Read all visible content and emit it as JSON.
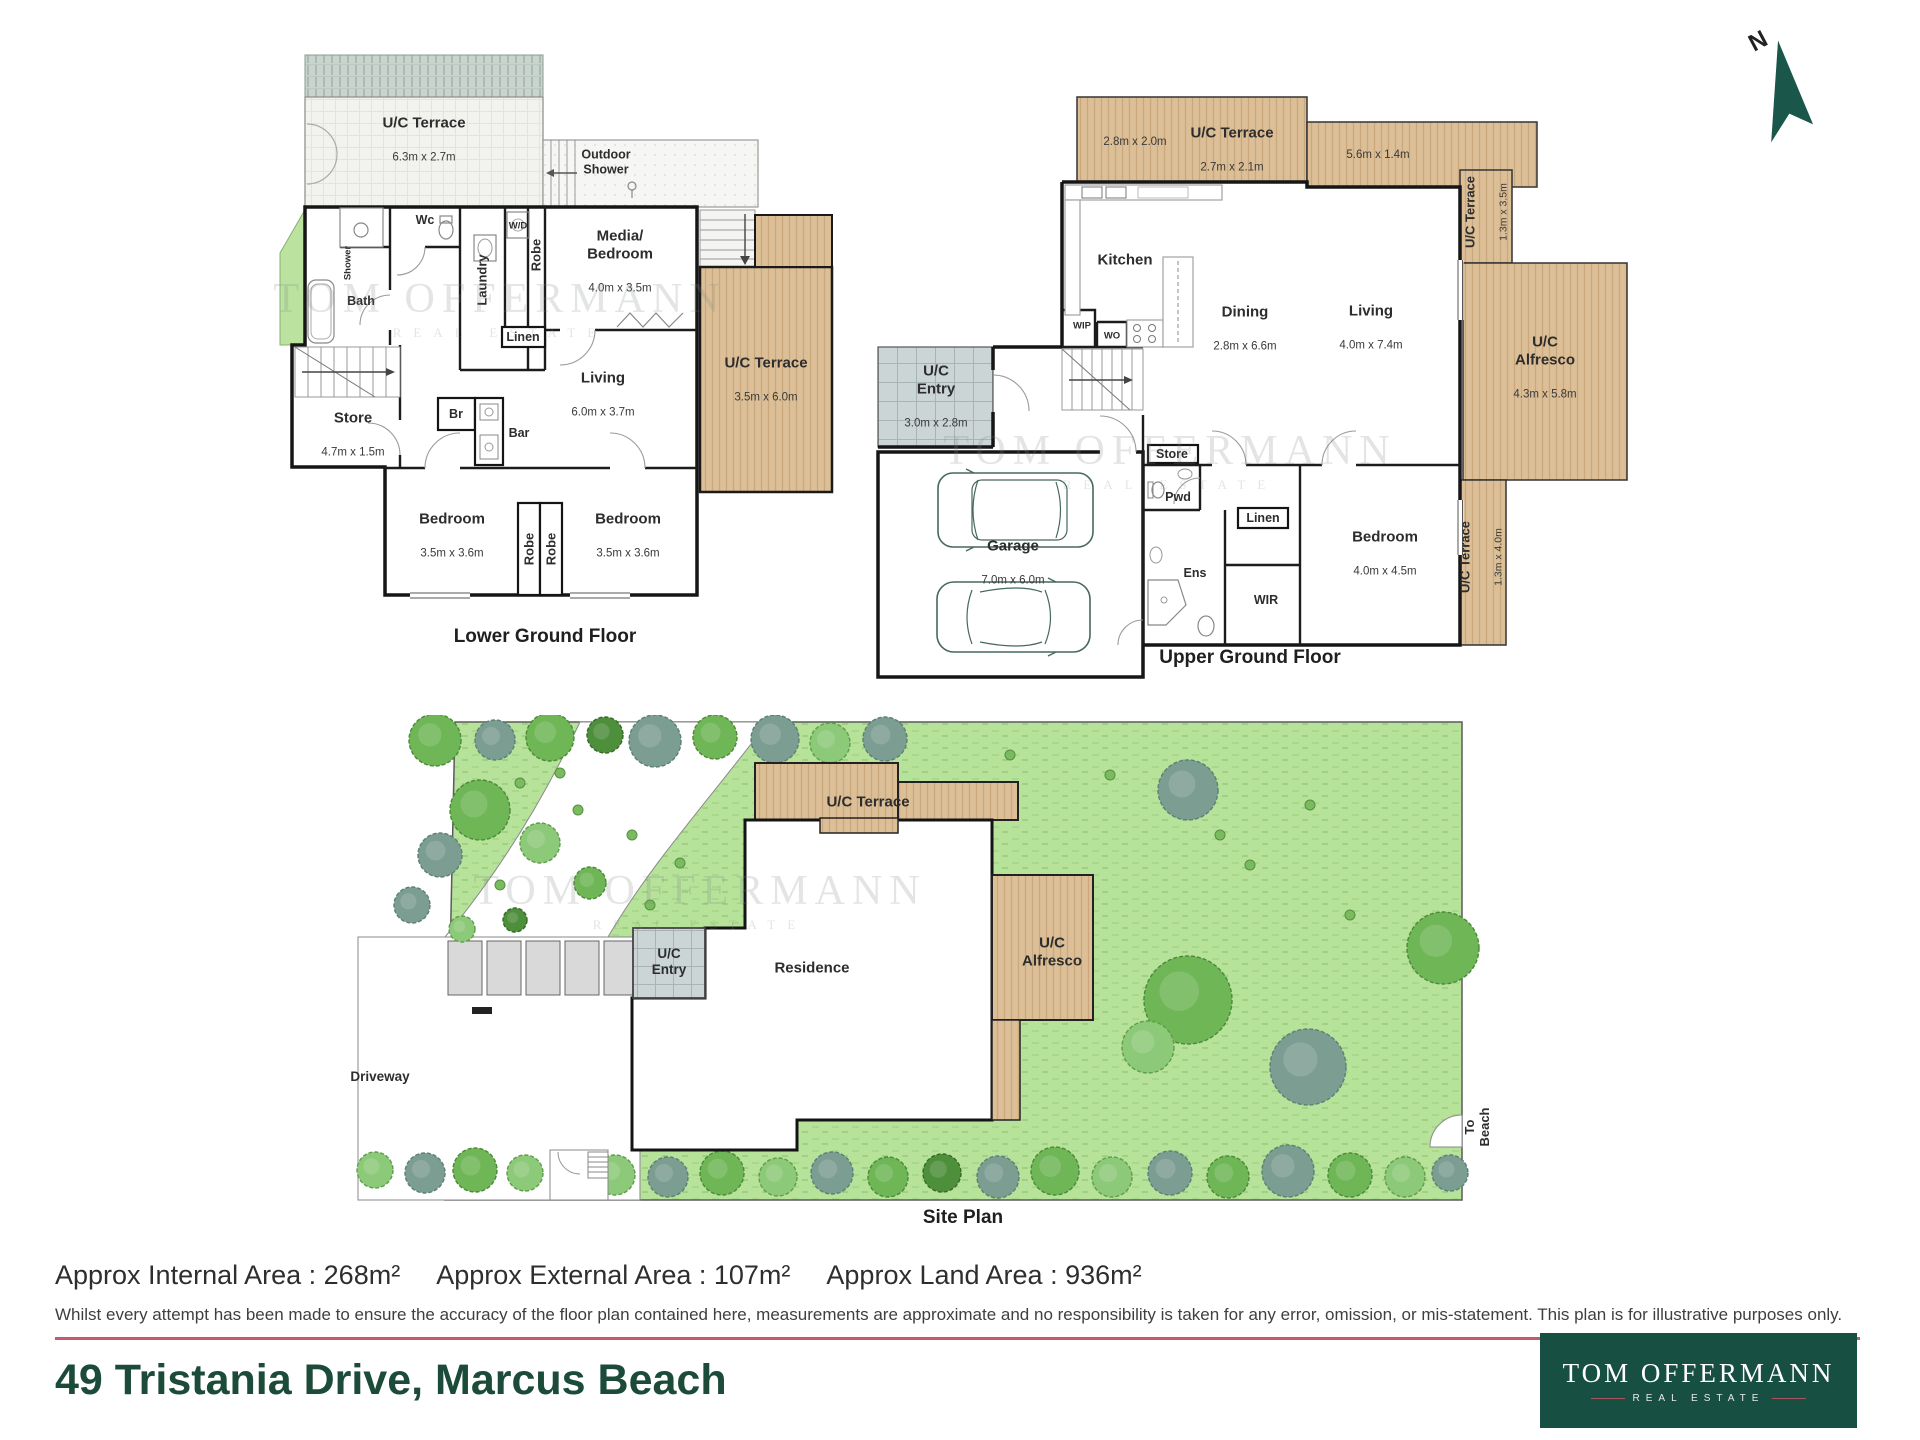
{
  "compass": {
    "label": "N"
  },
  "watermark": {
    "name": "TOM OFFERMANN",
    "tagline": "REAL ESTATE"
  },
  "lower_floor": {
    "title": "Lower Ground Floor",
    "terrace_top": {
      "name": "U/C Terrace",
      "dims": "6.3m x 2.7m"
    },
    "outdoor_shower": {
      "name": "Outdoor\nShower"
    },
    "wc": {
      "name": "Wc"
    },
    "shower": {
      "name": "Shower"
    },
    "bath": {
      "name": "Bath"
    },
    "laundry": {
      "name": "Laundry"
    },
    "wd": {
      "name": "W/D"
    },
    "robe_top": {
      "name": "Robe"
    },
    "media_bedroom": {
      "name": "Media/\nBedroom",
      "dims": "4.0m x 3.5m"
    },
    "linen": {
      "name": "Linen"
    },
    "living": {
      "name": "Living",
      "dims": "6.0m x 3.7m"
    },
    "store": {
      "name": "Store",
      "dims": "4.7m x 1.5m"
    },
    "br": {
      "name": "Br"
    },
    "bar": {
      "name": "Bar"
    },
    "bedroom_left": {
      "name": "Bedroom",
      "dims": "3.5m x 3.6m"
    },
    "robe_left": {
      "name": "Robe"
    },
    "robe_right": {
      "name": "Robe"
    },
    "bedroom_right": {
      "name": "Bedroom",
      "dims": "3.5m x 3.6m"
    },
    "terrace_right": {
      "name": "U/C Terrace",
      "dims": "3.5m x 6.0m"
    }
  },
  "upper_floor": {
    "title": "Upper Ground Floor",
    "terrace_top": {
      "name": "U/C Terrace",
      "dims": "2.7m x 2.1m",
      "left_dims": "2.8m x 2.0m",
      "right_dims": "5.6m x 1.4m"
    },
    "terrace_right": {
      "name": "U/C Terrace",
      "dims": "1.3m x 3.5m"
    },
    "alfresco": {
      "name": "U/C\nAlfresco",
      "dims": "4.3m x 5.8m"
    },
    "terrace_bottom": {
      "name": "U/C Terrace",
      "dims": "1.3m x 4.0m"
    },
    "kitchen": {
      "name": "Kitchen"
    },
    "wip": {
      "name": "WIP"
    },
    "wo": {
      "name": "WO"
    },
    "dining": {
      "name": "Dining",
      "dims": "2.8m x 6.6m"
    },
    "living": {
      "name": "Living",
      "dims": "4.0m x 7.4m"
    },
    "entry": {
      "name": "U/C\nEntry",
      "dims": "3.0m x 2.8m"
    },
    "garage": {
      "name": "Garage",
      "dims": "7.0m x 6.0m"
    },
    "store": {
      "name": "Store"
    },
    "pwd": {
      "name": "Pwd"
    },
    "linen": {
      "name": "Linen"
    },
    "bedroom": {
      "name": "Bedroom",
      "dims": "4.0m x 4.5m"
    },
    "ens": {
      "name": "Ens"
    },
    "wir": {
      "name": "WIR"
    }
  },
  "site_plan": {
    "title": "Site Plan",
    "terrace": {
      "name": "U/C Terrace"
    },
    "alfresco": {
      "name": "U/C\nAlfresco"
    },
    "entry": {
      "name": "U/C\nEntry"
    },
    "residence": {
      "name": "Residence"
    },
    "driveway": {
      "name": "Driveway"
    },
    "to_beach": {
      "name": "To Beach"
    }
  },
  "footer": {
    "internal_area": "Approx Internal Area : 268m²",
    "external_area": "Approx External Area : 107m²",
    "land_area": "Approx Land Area : 936m²",
    "disclaimer": "Whilst every attempt has been made to ensure the accuracy of the floor plan contained here, measurements are approximate and no responsibility is taken for any error, omission, or mis-statement. This plan is for illustrative purposes only.",
    "address": "49 Tristania Drive, Marcus Beach"
  },
  "logo": {
    "name": "TOM OFFERMANN",
    "tagline": "REAL ESTATE"
  },
  "colors": {
    "brand_green": "#175043",
    "accent_red": "#c25b70",
    "deck": "#dcbf97",
    "grass": "#b7e29a"
  }
}
